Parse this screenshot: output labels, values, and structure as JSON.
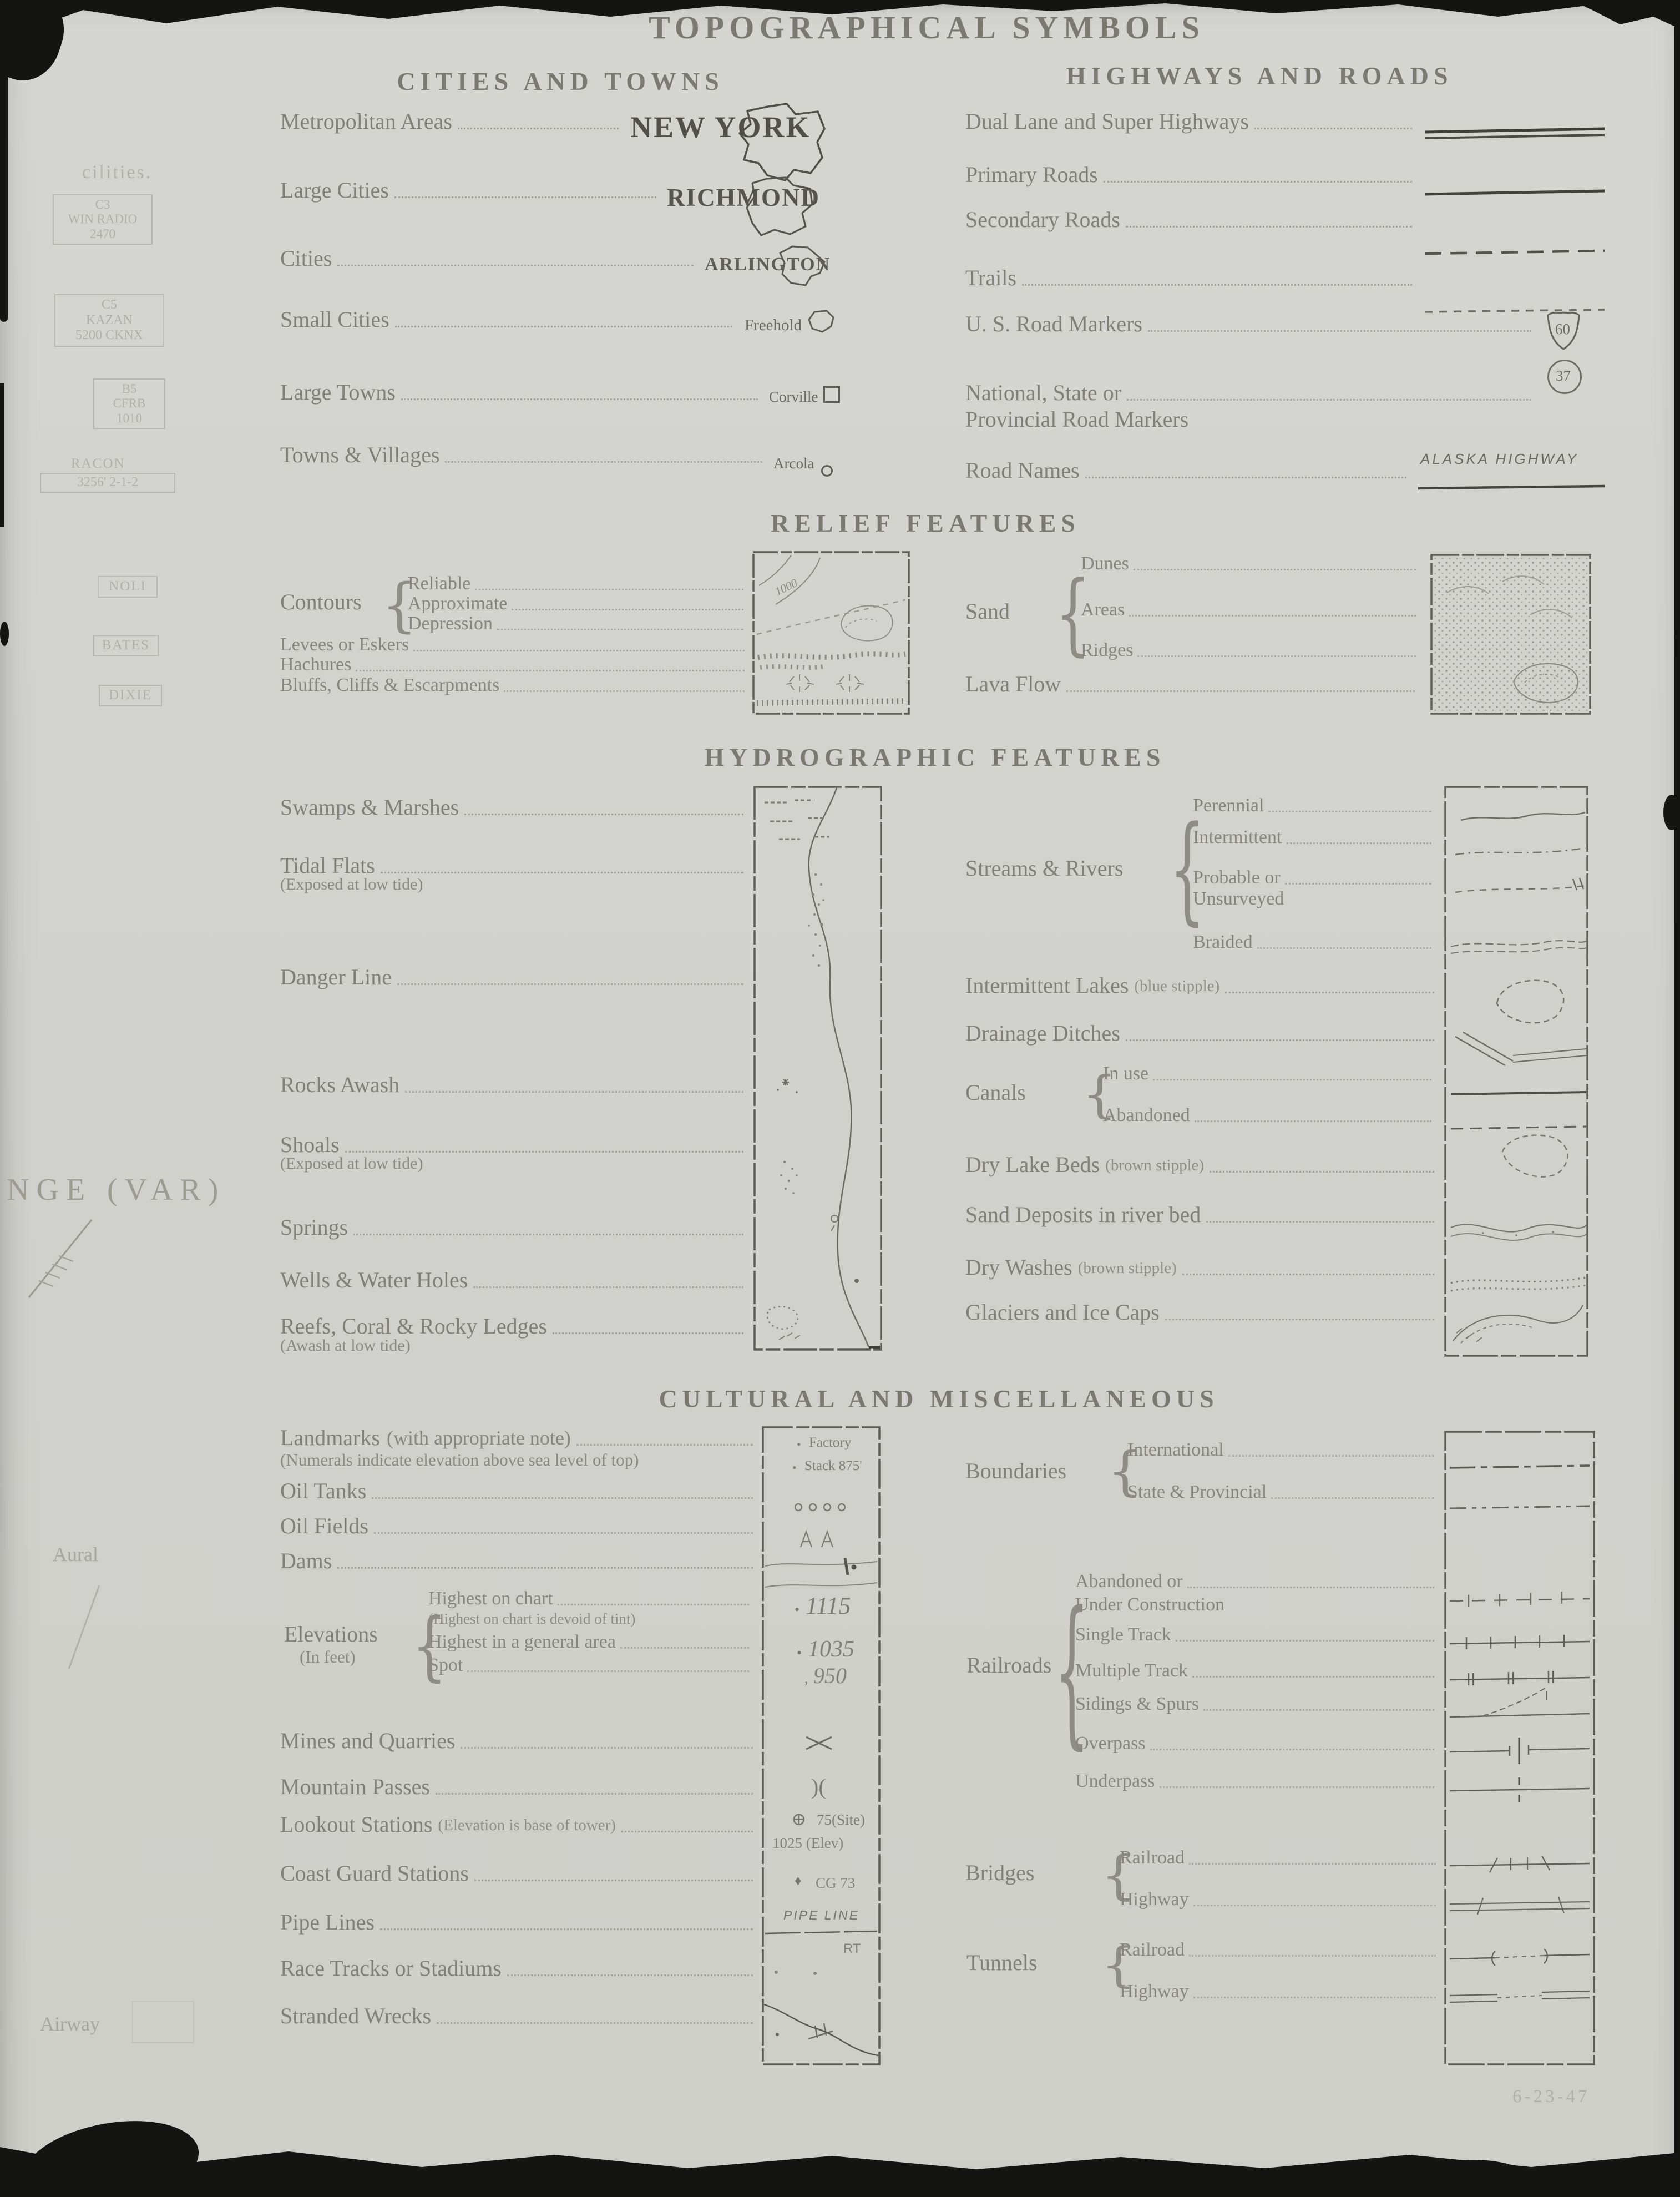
{
  "title": "TOPOGRAPHICAL SYMBOLS",
  "stamp": "6-23-47",
  "cities": {
    "heading": "CITIES AND TOWNS",
    "rows": [
      {
        "label": "Metropolitan Areas",
        "sym": "NEW YORK"
      },
      {
        "label": "Large Cities",
        "sym": "RICHMOND"
      },
      {
        "label": "Cities",
        "sym": "ARLINGTON"
      },
      {
        "label": "Small Cities",
        "sym": "Freehold"
      },
      {
        "label": "Large Towns",
        "sym": "Corville"
      },
      {
        "label": "Towns & Villages",
        "sym": "Arcola"
      }
    ]
  },
  "highways": {
    "heading": "HIGHWAYS AND ROADS",
    "rows": [
      {
        "label": "Dual Lane and Super Highways"
      },
      {
        "label": "Primary Roads"
      },
      {
        "label": "Secondary Roads"
      },
      {
        "label": "Trails"
      },
      {
        "label": "U. S. Road Markers",
        "sym": "60"
      },
      {
        "label": "National, State or",
        "label2": "Provincial Road Markers",
        "sym": "37"
      },
      {
        "label": "Road Names",
        "sym": "ALASKA HIGHWAY"
      }
    ]
  },
  "relief": {
    "heading": "RELIEF FEATURES",
    "contours": {
      "label": "Contours",
      "items": [
        "Reliable",
        "Approximate",
        "Depression"
      ]
    },
    "rows": [
      "Levees or Eskers",
      "Hachures",
      "Bluffs, Cliffs & Escarpments"
    ],
    "map_elev": "1000",
    "sand": {
      "label": "Sand",
      "items": [
        "Dunes",
        "Areas",
        "Ridges"
      ]
    },
    "lava": "Lava Flow"
  },
  "hydro": {
    "heading": "HYDROGRAPHIC FEATURES",
    "left": [
      {
        "label": "Swamps & Marshes"
      },
      {
        "label": "Tidal Flats",
        "note": "(Exposed at low tide)"
      },
      {
        "label": "Danger Line"
      },
      {
        "label": "Rocks Awash"
      },
      {
        "label": "Shoals",
        "note": "(Exposed at low tide)"
      },
      {
        "label": "Springs"
      },
      {
        "label": "Wells & Water Holes"
      },
      {
        "label": "Reefs, Coral & Rocky Ledges",
        "note": "(Awash at low tide)"
      }
    ],
    "streams": {
      "label": "Streams & Rivers",
      "items": [
        "Perennial",
        "Intermittent",
        "Probable or",
        "Unsurveyed",
        "Braided"
      ]
    },
    "lakes": {
      "label": "Intermittent Lakes",
      "paren": "(blue stipple)"
    },
    "ditches": "Drainage Ditches",
    "canals": {
      "label": "Canals",
      "items": [
        "In use",
        "Abandoned"
      ]
    },
    "drylake": {
      "label": "Dry Lake Beds",
      "paren": "(brown stipple)"
    },
    "sanddep": "Sand Deposits in river bed",
    "drywash": {
      "label": "Dry Washes",
      "paren": "(brown stipple)"
    },
    "glaciers": "Glaciers and Ice Caps"
  },
  "cultural": {
    "heading": "CULTURAL AND MISCELLANEOUS",
    "landmarks": {
      "label": "Landmarks",
      "paren": "(with appropriate note)",
      "note": "(Numerals indicate elevation above sea level of top)",
      "sym1": "Factory",
      "sym2": "Stack  875'"
    },
    "rows": [
      "Oil Tanks",
      "Oil Fields",
      "Dams"
    ],
    "elevations": {
      "label": "Elevations",
      "sub": "(In feet)",
      "items": [
        "Highest on chart",
        "(Highest on chart is devoid of tint)",
        "Highest in a general area",
        "Spot"
      ],
      "values": [
        "1115",
        "1035",
        "950"
      ]
    },
    "rows2": [
      {
        "label": "Mines and Quarries"
      },
      {
        "label": "Mountain Passes",
        "sym": ")("
      },
      {
        "label": "Lookout Stations",
        "paren": "(Elevation is base of tower)",
        "sym": "75(Site)",
        "sym2": "1025  (Elev)"
      },
      {
        "label": "Coast Guard Stations",
        "sym": "CG 73"
      },
      {
        "label": "Pipe Lines",
        "sym": "PIPE LINE"
      },
      {
        "label": "Race Tracks or Stadiums",
        "sym": "RT"
      },
      {
        "label": "Stranded Wrecks"
      }
    ],
    "boundaries": {
      "label": "Boundaries",
      "items": [
        "International",
        "State & Provincial"
      ]
    },
    "railroads": {
      "label": "Railroads",
      "items": [
        "Abandoned or",
        "Under Construction",
        "Single Track",
        "Multiple Track",
        "Sidings & Spurs",
        "Overpass",
        "Underpass"
      ]
    },
    "bridges": {
      "label": "Bridges",
      "items": [
        "Railroad",
        "Highway"
      ]
    },
    "tunnels": {
      "label": "Tunnels",
      "items": [
        "Railroad",
        "Highway"
      ]
    }
  },
  "margin": {
    "frag": "cilities.",
    "box1": {
      "l1": "C3",
      "l2": "WIN RADIO",
      "l3": "2470"
    },
    "box2": {
      "l1": "C5",
      "l2": "KAZAN",
      "l3": "5200 CKNX"
    },
    "box3": {
      "l1": "B5",
      "l2": "CFRB",
      "l3": "1010"
    },
    "racon": {
      "l1": "RACON",
      "l2": "3256'    2-1-2"
    },
    "tags": [
      "NOLI",
      "BATES",
      "DIXIE"
    ],
    "range": "NGE (VAR)",
    "aural": "Aural",
    "airway": "Airway"
  }
}
